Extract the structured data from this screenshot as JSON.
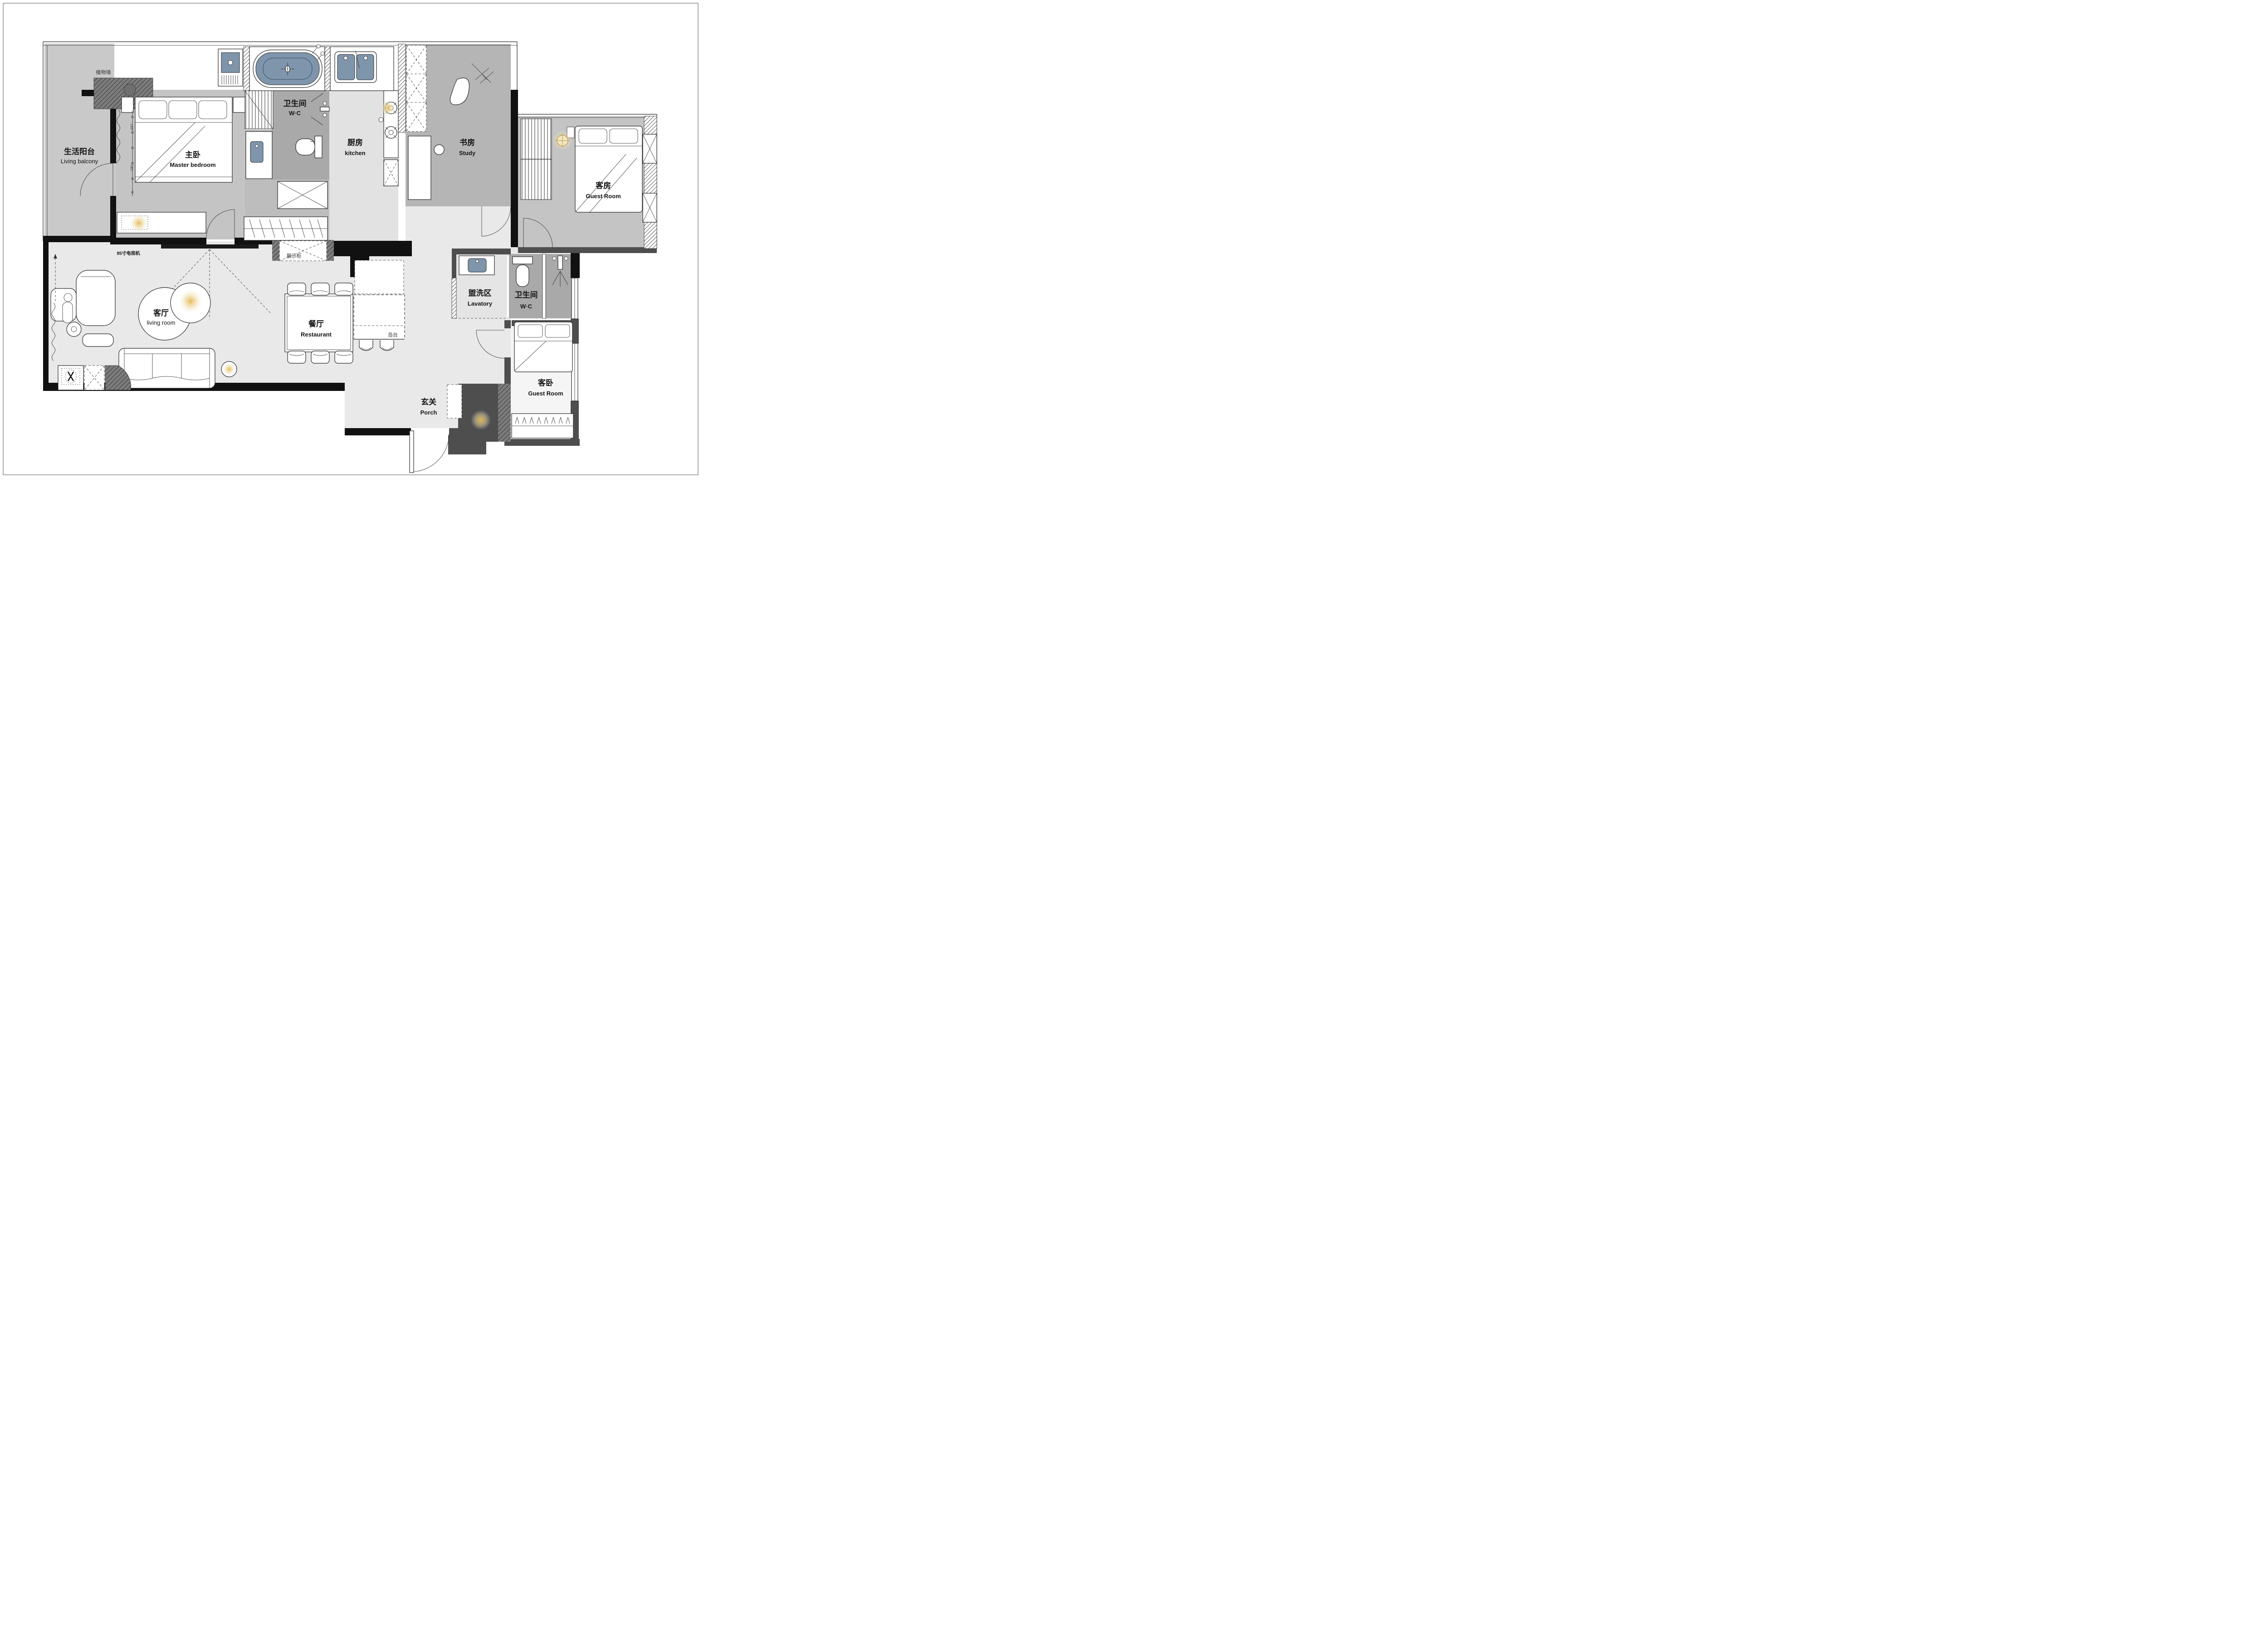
{
  "rooms": {
    "living_balcony": {
      "zh": "生活阳台",
      "en": "Living balcony"
    },
    "master_bedroom": {
      "zh": "主卧",
      "en": "Master bedroom"
    },
    "wc_top": {
      "zh": "卫生间",
      "en": "W·C"
    },
    "kitchen": {
      "zh": "厨房",
      "en": "kitchen"
    },
    "study": {
      "zh": "书房",
      "en": "Study"
    },
    "guest_room": {
      "zh": "客房",
      "en": "Guest Room"
    },
    "living_room": {
      "zh": "客厅",
      "en": "living room"
    },
    "restaurant": {
      "zh": "餐厅",
      "en": "Restaurant"
    },
    "lavatory": {
      "zh": "盥洗区",
      "en": "Lavatory"
    },
    "wc_right": {
      "zh": "卫生间",
      "en": "W·C"
    },
    "guest_bedroom": {
      "zh": "客卧",
      "en": "Guest Room"
    },
    "porch": {
      "zh": "玄关",
      "en": "Porch"
    }
  },
  "annotations": {
    "plant_wall": "植物墙",
    "tv": "85寸电视机",
    "display_cabinet": "展示柜",
    "island": "岛台",
    "led": "LED"
  },
  "colors": {
    "wall_black": "#111111",
    "wall_dark": "#4e4e4e",
    "floor_light": "#e9e9e9",
    "floor_mid": "#c7c7c7",
    "floor_dark": "#a9a9a9",
    "water_blue": "#7e95ab",
    "lamp_glow": "#e8c878"
  }
}
